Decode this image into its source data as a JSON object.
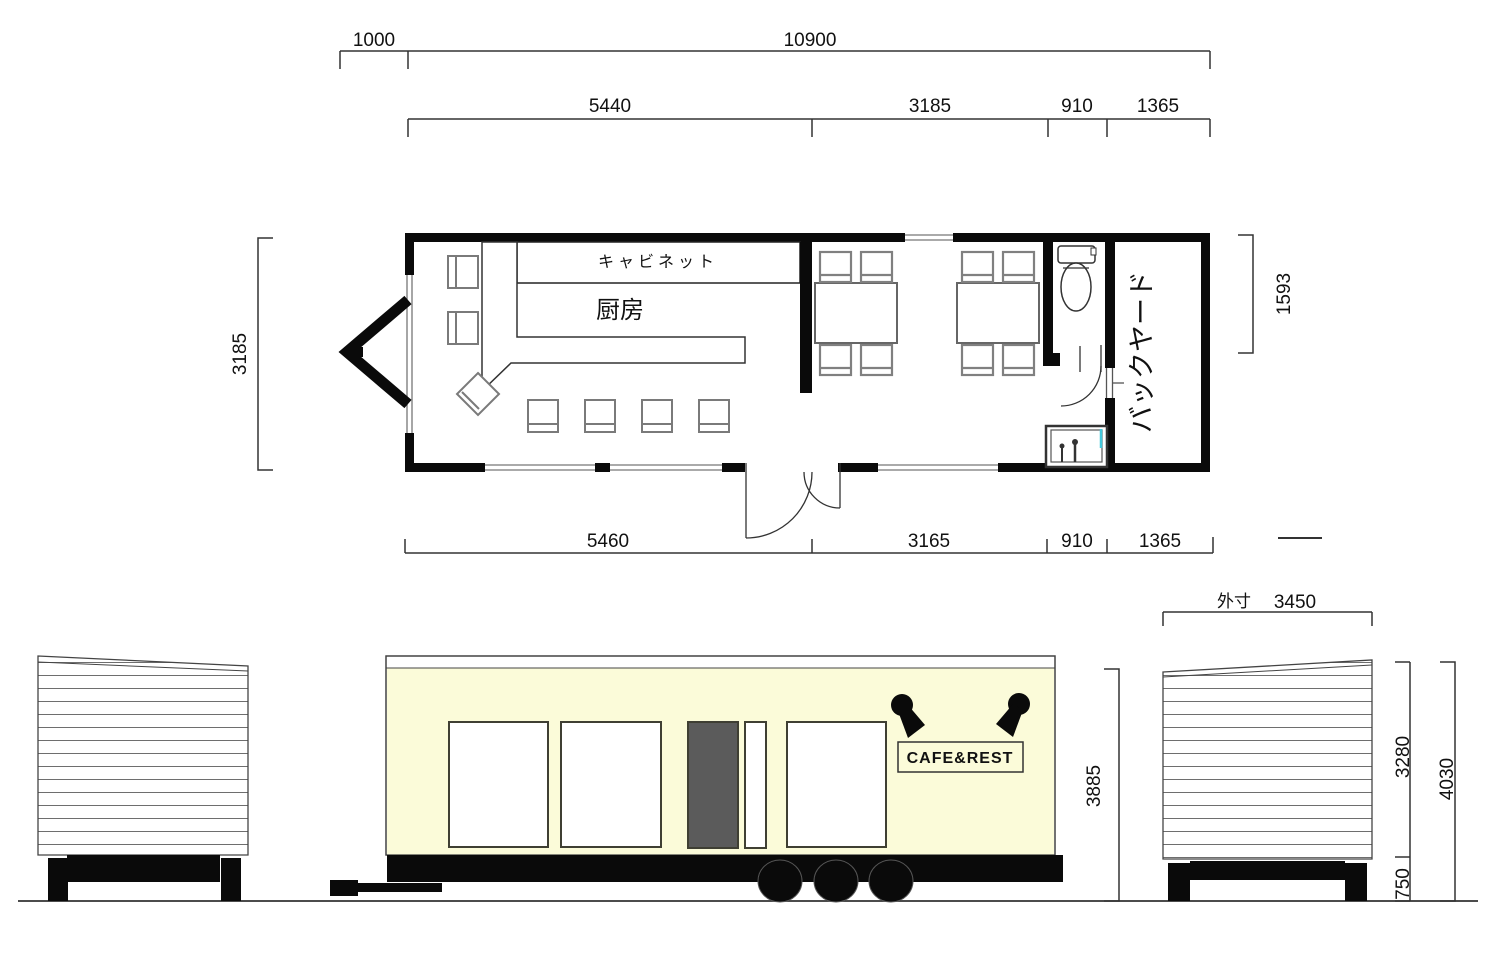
{
  "drawing": {
    "plan": {
      "dim_hitch": "1000",
      "dim_total_width": "10900",
      "dims_top": [
        "5440",
        "3185",
        "910",
        "1365"
      ],
      "dims_bottom": [
        "5460",
        "3165",
        "910",
        "1365"
      ],
      "dim_depth": "3185",
      "dim_right_depth": "1593",
      "label_cabinet": "キャビネット",
      "label_kitchen": "厨房",
      "label_backyard": "バックヤード"
    },
    "front": {
      "sign": "CAFE&REST",
      "dim_height": "3885"
    },
    "side": {
      "label_outer": "外寸",
      "dim_outer_width": "3450",
      "dim_body_height": "3280",
      "dim_total_height": "4030",
      "dim_chassis": "750"
    },
    "colors": {
      "body": "#FBFBD9",
      "door": "#5B5B5B",
      "accent": "#44C8DC"
    }
  }
}
